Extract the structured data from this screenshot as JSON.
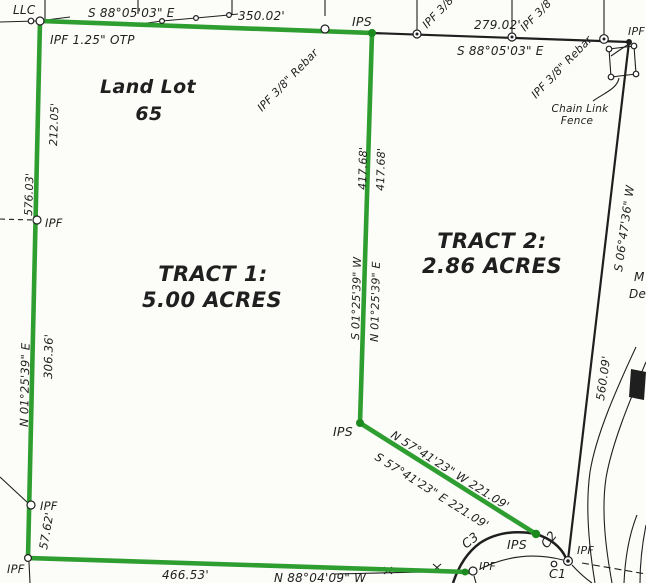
{
  "colors": {
    "boundary_green": "#2f9e30",
    "boundary_green_dark": "#1d8a1f",
    "ink": "#1f1f1f",
    "paper": "#fcfcf9"
  },
  "land_lot": {
    "line1": "Land Lot",
    "line2": "65"
  },
  "tract1": {
    "name": "TRACT 1:",
    "area": "5.00 ACRES"
  },
  "tract2": {
    "name": "TRACT 2:",
    "area": "2.86 ACRES"
  },
  "labels": {
    "llc": "LLC",
    "top": {
      "bearing_w": "S 88°05'03\" E",
      "dist_w": "350.02'",
      "ipf_otp": "IPF 1.25\" OTP",
      "rebar_w": "IPF 3/8\" Rebar",
      "ips": "IPS",
      "ipf38_a": "IPF 3/8",
      "dist_e": "279.02'",
      "ipf38_b": "IPF 3/8",
      "bearing_e": "S 88°05'03\" E",
      "rebar_e": "IPF 3/8\" Rebar",
      "ipf_corner": "IPF"
    },
    "fence": {
      "line1": "Chain Link",
      "line2": "Fence"
    },
    "left": {
      "d212": "212.05'",
      "d576": "576.03'",
      "ipf_upper": "IPF",
      "bearing": "N 01°25'39\" E",
      "d306": "306.36'",
      "ipf_lower": "IPF",
      "d5762": "57.62'",
      "ipf_corner": "IPF"
    },
    "middle": {
      "d417_w": "417.68'",
      "d417_e": "417.68'",
      "bearing_w": "S 01°25'39\" W",
      "bearing_e": "N 01°25'39\" E",
      "ips": "IPS"
    },
    "diagonal": {
      "bearing_n": "N 57°41'23\" W  221.09'",
      "bearing_s": "S 57°41'23\" E  221.09'"
    },
    "right": {
      "bearing": "S 06°47'36\" W",
      "d560": "560.09'",
      "edge_m": "M",
      "edge_de": "De"
    },
    "bottom": {
      "d466": "466.53'",
      "bearing": "N 88°04'09\" W"
    },
    "curves": {
      "c1": "C1",
      "c2": "C2",
      "c3": "C3",
      "ips": "IPS",
      "ipf_w": "IPF",
      "ipf_e": "IPF"
    }
  }
}
